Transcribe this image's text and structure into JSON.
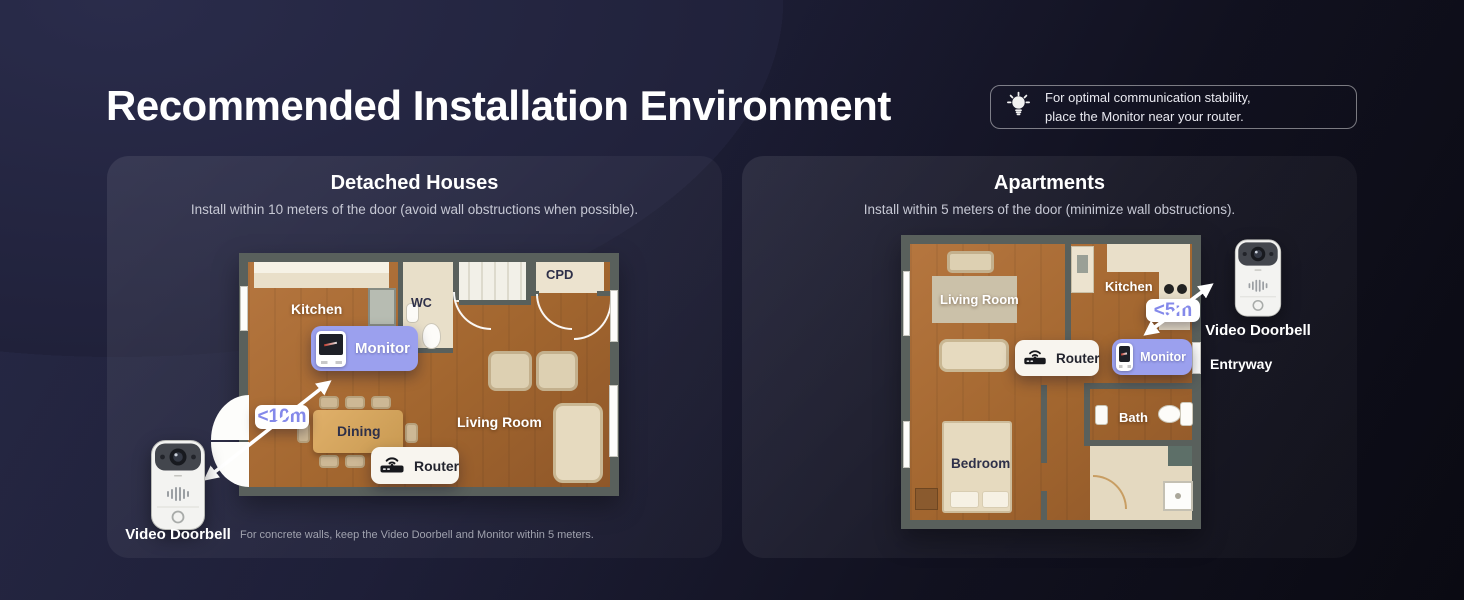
{
  "page": {
    "title": "Recommended Installation Environment",
    "tip": {
      "line1": "For optimal communication stability,",
      "line2": "place the Monitor near your router."
    }
  },
  "panels": {
    "detached": {
      "heading": "Detached Houses",
      "subtitle": "Install within 10 meters of the door (avoid wall obstructions when possible).",
      "distance_label": "<10m",
      "rooms": {
        "kitchen": "Kitchen",
        "wc": "WC",
        "cpd": "CPD",
        "dining": "Dining",
        "living": "Living Room"
      },
      "monitor_label": "Monitor",
      "router_label": "Router",
      "doorbell_label": "Video Doorbell",
      "note": "For concrete walls, keep the Video Doorbell and Monitor within 5 meters."
    },
    "apartments": {
      "heading": "Apartments",
      "subtitle": "Install within 5 meters of the door (minimize wall obstructions).",
      "distance_label": "<5m",
      "rooms": {
        "living": "Living Room",
        "kitchen": "Kitchen",
        "bedroom": "Bedroom",
        "bath": "Bath"
      },
      "monitor_label": "Monitor",
      "router_label": "Router",
      "doorbell_label": "Video Doorbell",
      "entry_label": "Entryway"
    }
  },
  "colors": {
    "accent_lavender": "#9ba0ee",
    "distance_text": "#8489ea",
    "wall_gray": "#59605c",
    "floor_wood": "#a2662f",
    "page_bg_top": "#2a2c4b",
    "page_bg_bottom": "#0a0a12"
  }
}
